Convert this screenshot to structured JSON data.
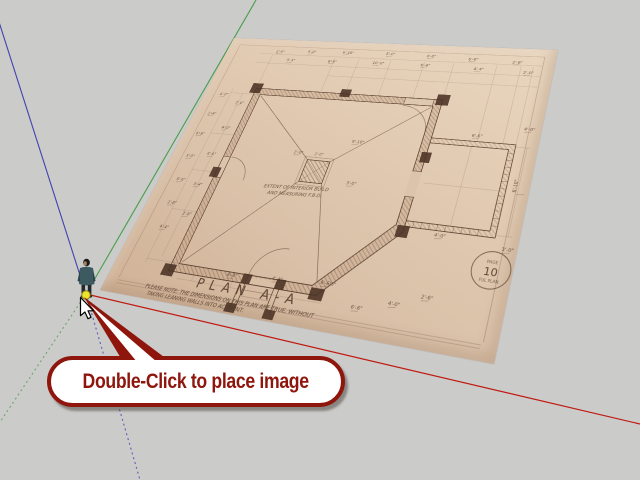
{
  "viewport": {
    "background": "#cbcbca",
    "tool_hint": "Double-Click to place image"
  },
  "callout": {
    "text": "Double-Click to place image",
    "accent_color": "#8e160c",
    "fill_color": "#ffffff"
  },
  "axes": {
    "origin": [
      86,
      294
    ],
    "red": {
      "color": "#c01910",
      "solid_end": [
        640,
        424
      ]
    },
    "green": {
      "color": "#4a9e4a",
      "solid_end": [
        256,
        0
      ],
      "dotted_end": [
        0,
        422
      ]
    },
    "blue": {
      "color": "#4242b2",
      "solid_end": [
        -8,
        0
      ],
      "dotted_end": [
        140,
        480
      ]
    }
  },
  "origin_marker": {
    "color": "#efe32b",
    "edge": "#8a8420"
  },
  "placed_image": {
    "title": "PLAN  A-A",
    "center_note_line1": "EXTENT OF INTERIOR BUILD",
    "center_note_line2": "AND MEASURING F.B.D.",
    "footnote_line1": "PLEASE NOTE: THE DIMENSIONS ON THIS PLAN ARE TRUE, WITHOUT",
    "footnote_line2": "TAKING LEANING WALLS INTO ACCOUNT.",
    "column_label": "2'-0\"",
    "seal": {
      "top": "PAGE",
      "number": "10",
      "bottom": "FUL PLAN"
    },
    "ink_color": "#503827",
    "paper_color": "#ddc5ad",
    "dims": [
      {
        "x": 78,
        "y": 23,
        "t": "2'-6\""
      },
      {
        "x": 126,
        "y": 21,
        "t": "4'-0\""
      },
      {
        "x": 178,
        "y": 20,
        "t": "6'-10\""
      },
      {
        "x": 240,
        "y": 19,
        "t": "5'-0\""
      },
      {
        "x": 296,
        "y": 20,
        "t": "4'-0\""
      },
      {
        "x": 352,
        "y": 22,
        "t": "6'-6\""
      },
      {
        "x": 408,
        "y": 24,
        "t": "2'-8\""
      },
      {
        "x": 100,
        "y": 37,
        "t": "3'-4\""
      },
      {
        "x": 162,
        "y": 36,
        "t": "6'-6\""
      },
      {
        "x": 226,
        "y": 35,
        "t": "10'-0\""
      },
      {
        "x": 292,
        "y": 35,
        "t": "6'-6\""
      },
      {
        "x": 362,
        "y": 37,
        "t": "4'-4\""
      },
      {
        "x": 424,
        "y": 39,
        "t": "2'-0\""
      },
      {
        "x": 24,
        "y": 100,
        "t": "4'-0\""
      },
      {
        "x": 21,
        "y": 132,
        "t": "2'-6\""
      },
      {
        "x": 19,
        "y": 164,
        "t": "6'-6\""
      },
      {
        "x": 21,
        "y": 198,
        "t": "3'-0\""
      },
      {
        "x": 25,
        "y": 232,
        "t": "6'-6\""
      },
      {
        "x": 29,
        "y": 264,
        "t": "2'-8\""
      },
      {
        "x": 35,
        "y": 296,
        "t": "4'-4\""
      },
      {
        "x": 54,
        "y": 112,
        "t": "2'-0\""
      },
      {
        "x": 52,
        "y": 152,
        "t": "4'-0\""
      },
      {
        "x": 50,
        "y": 192,
        "t": "6'-6\""
      },
      {
        "x": 52,
        "y": 236,
        "t": "3'-4\""
      },
      {
        "x": 57,
        "y": 276,
        "t": "2'-6\""
      },
      {
        "x": 440,
        "y": 120,
        "t": "4'-0\""
      },
      {
        "x": 444,
        "y": 268,
        "t": "3'-0\""
      },
      {
        "x": 446,
        "y": 200,
        "t": "6'-10\"",
        "r": -90
      },
      {
        "x": 238,
        "y": 156,
        "t": "9'-10\""
      },
      {
        "x": 168,
        "y": 178,
        "t": "2'-0\""
      },
      {
        "x": 250,
        "y": 212,
        "t": "3'-0\""
      },
      {
        "x": 150,
        "y": 340,
        "t": "6'-6\""
      },
      {
        "x": 205,
        "y": 336,
        "t": "4'-4\""
      },
      {
        "x": 262,
        "y": 332,
        "t": "6'-6½\""
      },
      {
        "x": 304,
        "y": 352,
        "t": "6'-6\""
      },
      {
        "x": 342,
        "y": 342,
        "t": "4'-0\""
      },
      {
        "x": 374,
        "y": 330,
        "t": "2'-6\""
      },
      {
        "x": 382,
        "y": 134,
        "t": "6'-6\""
      },
      {
        "x": 370,
        "y": 262,
        "t": "4'-0\""
      }
    ]
  },
  "figure": {
    "name": "scale-figure",
    "jacket": "#3c5a60",
    "jacket_shade": "#2c454c",
    "pants": "#22282c",
    "hair": "#1c1a18",
    "face": "#a08060"
  }
}
